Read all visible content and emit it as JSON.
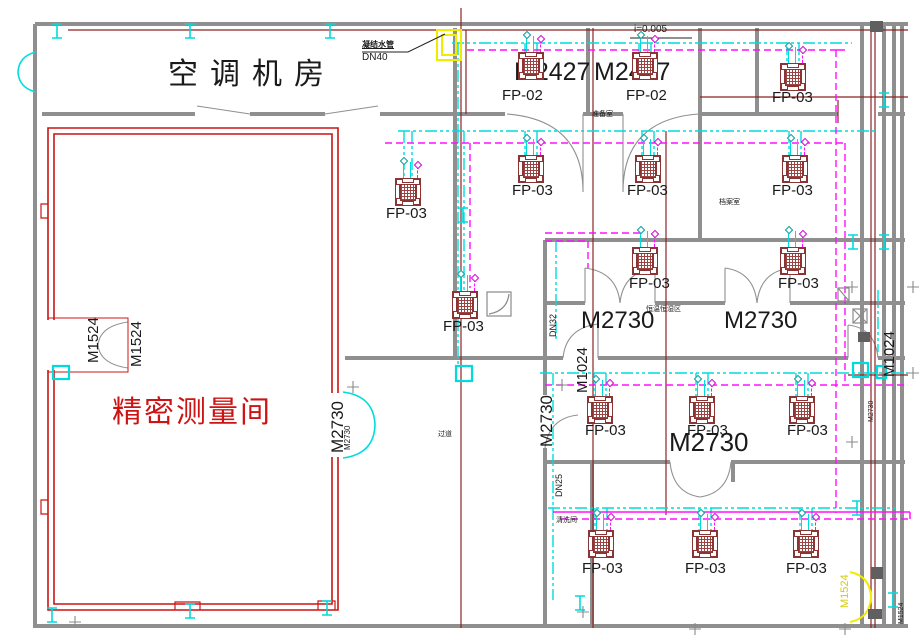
{
  "colors": {
    "wall": "#8f8f8f",
    "red_room": "#cc1414",
    "grid_line": "#8b2424",
    "chilled_pipe": "#00dcdc",
    "supply_pipe": "#ff10ff",
    "highlight": "#f0ec00"
  },
  "rooms": {
    "machine_room": "空调机房",
    "precision_room": "精密测量间"
  },
  "labels": [
    {
      "id": "room-machine",
      "text": "空调机房",
      "x": 168,
      "y": 60,
      "size": 30,
      "ls": 12,
      "color": "#1a1a1a"
    },
    {
      "id": "room-precision",
      "text": "精密测量间",
      "x": 112,
      "y": 398,
      "size": 30,
      "ls": 2,
      "color": "#cc1414"
    },
    {
      "id": "door-m2427-1",
      "text": "M2427",
      "x": 514,
      "y": 60,
      "size": 25
    },
    {
      "id": "door-m2427-2",
      "text": "M2427",
      "x": 594,
      "y": 60,
      "size": 25
    },
    {
      "id": "fcu-fp02-1",
      "text": "FP-02",
      "x": 502,
      "y": 88,
      "size": 15
    },
    {
      "id": "fcu-fp02-2",
      "text": "FP-02",
      "x": 626,
      "y": 88,
      "size": 15
    },
    {
      "id": "fcu-fp03-1",
      "text": "FP-03",
      "x": 772,
      "y": 90,
      "size": 15
    },
    {
      "id": "fcu-fp03-2",
      "text": "FP-03",
      "x": 386,
      "y": 206,
      "size": 15
    },
    {
      "id": "fcu-fp03-3",
      "text": "FP-03",
      "x": 512,
      "y": 183,
      "size": 15
    },
    {
      "id": "fcu-fp03-4",
      "text": "FP-03",
      "x": 627,
      "y": 183,
      "size": 15
    },
    {
      "id": "fcu-fp03-5",
      "text": "FP-03",
      "x": 772,
      "y": 183,
      "size": 15
    },
    {
      "id": "fcu-fp03-6",
      "text": "FP-03",
      "x": 443,
      "y": 319,
      "size": 15
    },
    {
      "id": "fcu-fp03-7",
      "text": "FP-03",
      "x": 629,
      "y": 276,
      "size": 15
    },
    {
      "id": "fcu-fp03-8",
      "text": "FP-03",
      "x": 778,
      "y": 276,
      "size": 15
    },
    {
      "id": "fcu-fp03-9",
      "text": "FP-03",
      "x": 585,
      "y": 423,
      "size": 15
    },
    {
      "id": "fcu-fp03-10",
      "text": "FP-03",
      "x": 687,
      "y": 423,
      "size": 15
    },
    {
      "id": "fcu-fp03-11",
      "text": "FP-03",
      "x": 787,
      "y": 423,
      "size": 15
    },
    {
      "id": "fcu-fp03-12",
      "text": "FP-03",
      "x": 582,
      "y": 561,
      "size": 15
    },
    {
      "id": "fcu-fp03-13",
      "text": "FP-03",
      "x": 685,
      "y": 561,
      "size": 15
    },
    {
      "id": "fcu-fp03-14",
      "text": "FP-03",
      "x": 786,
      "y": 561,
      "size": 15
    },
    {
      "id": "door-m2730-h1",
      "text": "M2730",
      "x": 581,
      "y": 309,
      "size": 24
    },
    {
      "id": "door-m2730-h2",
      "text": "M2730",
      "x": 724,
      "y": 309,
      "size": 24
    },
    {
      "id": "door-m2730-h3",
      "text": "M2730",
      "x": 669,
      "y": 429,
      "size": 26
    },
    {
      "id": "door-m2730-v1",
      "text": "M2730",
      "x": 329,
      "y": 453,
      "size": 17,
      "rot": true
    },
    {
      "id": "door-m2730-v1b",
      "text": "M2730",
      "x": 344,
      "y": 450,
      "size": 8,
      "rot": true
    },
    {
      "id": "door-m2730-v2",
      "text": "M2730",
      "x": 538,
      "y": 447,
      "size": 17,
      "rot": true
    },
    {
      "id": "door-m1024-v1",
      "text": "M1024",
      "x": 575,
      "y": 393,
      "size": 15,
      "rot": true
    },
    {
      "id": "door-m1024-v2",
      "text": "M1024",
      "x": 882,
      "y": 377,
      "size": 15,
      "rot": true
    },
    {
      "id": "door-m1524-v1",
      "text": "M1524",
      "x": 86,
      "y": 363,
      "size": 15,
      "rot": true
    },
    {
      "id": "door-m1524-v2",
      "text": "M1524",
      "x": 129,
      "y": 367,
      "size": 15,
      "rot": true
    },
    {
      "id": "door-m1524-hl",
      "text": "M1524",
      "x": 840,
      "y": 608,
      "size": 11,
      "rot": true,
      "color": "#d8cc00"
    },
    {
      "id": "door-m2730-vt",
      "text": "M2730",
      "x": 868,
      "y": 422,
      "size": 7,
      "rot": true
    },
    {
      "id": "door-m1524-vt",
      "text": "M1524",
      "x": 898,
      "y": 624,
      "size": 7,
      "rot": true
    },
    {
      "id": "pipe-dn32",
      "text": "DN32",
      "x": 549,
      "y": 337,
      "size": 9,
      "rot": true
    },
    {
      "id": "pipe-dn25",
      "text": "DN25",
      "x": 555,
      "y": 497,
      "size": 9,
      "rot": true
    },
    {
      "id": "pipe-note",
      "text": "凝结水管",
      "x": 362,
      "y": 41,
      "size": 8,
      "bold": true,
      "under": true
    },
    {
      "id": "pipe-dn40",
      "text": "DN40",
      "x": 362,
      "y": 53,
      "size": 10
    },
    {
      "id": "slope-note",
      "text": "i=0.005",
      "x": 634,
      "y": 25,
      "size": 10
    },
    {
      "id": "room-small-1",
      "text": "准备室",
      "x": 592,
      "y": 111,
      "size": 7
    },
    {
      "id": "room-small-2",
      "text": "档案室",
      "x": 719,
      "y": 199,
      "size": 7
    },
    {
      "id": "room-small-3",
      "text": "恒温恒湿区",
      "x": 646,
      "y": 306,
      "size": 7
    },
    {
      "id": "room-small-4",
      "text": "清洗间",
      "x": 556,
      "y": 517,
      "size": 7
    },
    {
      "id": "room-small-5",
      "text": "过道",
      "x": 438,
      "y": 431,
      "size": 7
    }
  ],
  "fcu_units": [
    {
      "cx": 531,
      "top": 52,
      "model": "FP-02"
    },
    {
      "cx": 645,
      "top": 52,
      "model": "FP-02"
    },
    {
      "cx": 793,
      "top": 63,
      "model": "FP-03"
    },
    {
      "cx": 408,
      "top": 178,
      "model": "FP-03"
    },
    {
      "cx": 531,
      "top": 155,
      "model": "FP-03"
    },
    {
      "cx": 648,
      "top": 155,
      "model": "FP-03"
    },
    {
      "cx": 795,
      "top": 155,
      "model": "FP-03"
    },
    {
      "cx": 465,
      "top": 291,
      "model": "FP-03"
    },
    {
      "cx": 645,
      "top": 247,
      "model": "FP-03"
    },
    {
      "cx": 793,
      "top": 247,
      "model": "FP-03"
    },
    {
      "cx": 600,
      "top": 396,
      "model": "FP-03"
    },
    {
      "cx": 702,
      "top": 396,
      "model": "FP-03"
    },
    {
      "cx": 802,
      "top": 396,
      "model": "FP-03"
    },
    {
      "cx": 601,
      "top": 530,
      "model": "FP-03"
    },
    {
      "cx": 705,
      "top": 530,
      "model": "FP-03"
    },
    {
      "cx": 806,
      "top": 530,
      "model": "FP-03"
    }
  ]
}
